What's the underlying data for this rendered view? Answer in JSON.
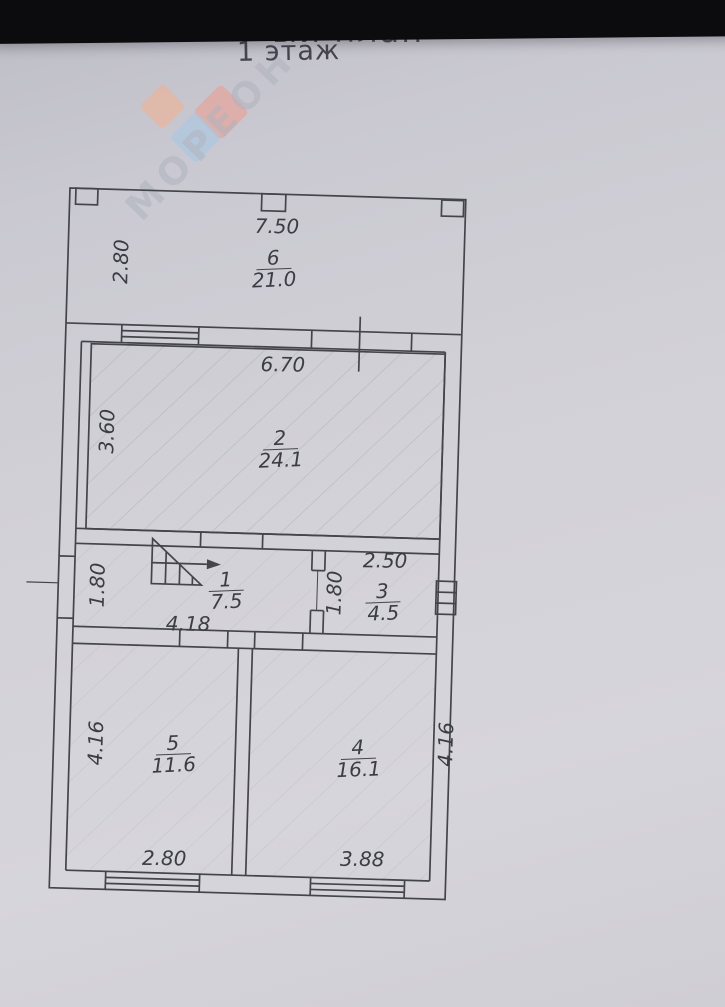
{
  "page": {
    "title_partial": "ый план",
    "floor_label": "1 этаж"
  },
  "watermark": {
    "text": "МОРЕОН",
    "colors": {
      "orange": "#f0b193",
      "red": "#eb9f92",
      "blue": "#a9c6e2"
    }
  },
  "plan": {
    "paper_color": "#d2d1d7",
    "line_color": "#43454b",
    "rooms": {
      "r6": {
        "number": "6",
        "area": "21.0"
      },
      "r2": {
        "number": "2",
        "area": "24.1"
      },
      "r1": {
        "number": "1",
        "area": "7.5"
      },
      "r3": {
        "number": "3",
        "area": "4.5"
      },
      "r5": {
        "number": "5",
        "area": "11.6"
      },
      "r4": {
        "number": "4",
        "area": "16.1"
      }
    },
    "dims": {
      "veranda_width": "7.50",
      "veranda_height": "2.80",
      "r2_width": "6.70",
      "r2_height": "3.60",
      "r1_width": "4.18",
      "r1_height": "1.80",
      "r3_width": "2.50",
      "r3_height": "1.80",
      "r5_width": "2.80",
      "r5_height": "4.16",
      "r4_width": "3.88",
      "r4_height": "4.16"
    }
  }
}
